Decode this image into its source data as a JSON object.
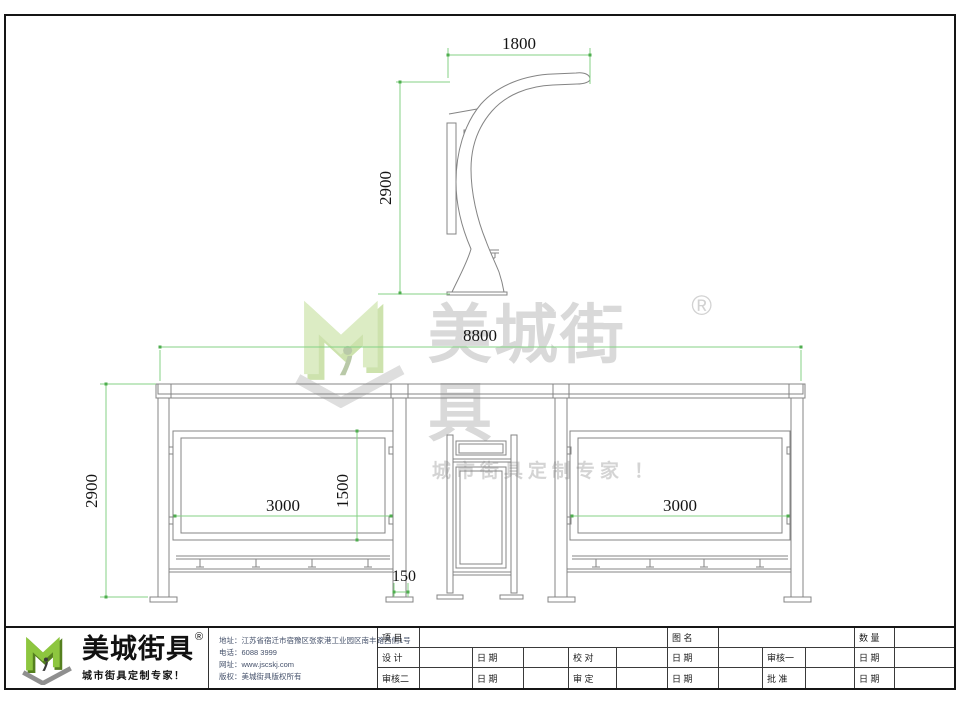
{
  "side_view": {
    "dim_top": "1800",
    "dim_left": "2900"
  },
  "front_view": {
    "dim_width": "8800",
    "dim_height": "2900",
    "dim_left_panel": "3000",
    "dim_right_panel": "3000",
    "dim_panel_height": "1500",
    "dim_post": "150"
  },
  "watermark": {
    "brand": "美城街具",
    "reg": "®",
    "tagline": "城市街具定制专家 ！"
  },
  "footer": {
    "logo": {
      "brand": "美城街具",
      "reg": "®",
      "tagline": "城市街具定制专家！"
    },
    "contact": {
      "address": "地址：江苏省宿迁市宿豫区张家港工业园区南丰路西侧1号",
      "phone": "电话：6088 3999",
      "website": "网址：www.jscskj.com",
      "copyright": "版权：美城街具版权所有"
    },
    "table": {
      "project_label": "项 目",
      "drawing_label": "图 名",
      "qty_label": "数 量",
      "r2": [
        "设 计",
        "日 期",
        "校 对",
        "日 期",
        "审核一",
        "日 期"
      ],
      "r3": [
        "审核二",
        "日 期",
        "审 定",
        "日 期",
        "批 准",
        "日 期"
      ]
    }
  },
  "colors": {
    "dimension_line": "#84d284",
    "object_line": "#848484",
    "logo_green": "#8dc63f",
    "watermark_gray": "#d9d9d9"
  }
}
